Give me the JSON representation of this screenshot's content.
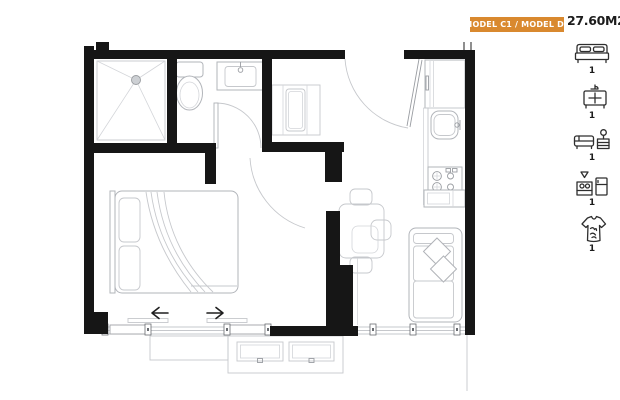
{
  "header": {
    "model_label": "MODEL C1 / MODEL D2",
    "area_label": "27.60M2"
  },
  "legend": {
    "items": [
      {
        "id": "bedroom",
        "icon": "bed-icon",
        "count": "1"
      },
      {
        "id": "bathroom",
        "icon": "bathroom-vanity-icon",
        "count": "1"
      },
      {
        "id": "living-room",
        "icon": "sofa-lamp-icon",
        "count": "1"
      },
      {
        "id": "kitchen",
        "icon": "kitchen-icon",
        "count": "1"
      },
      {
        "id": "wardrobe",
        "icon": "tshirt-icon",
        "count": "1"
      }
    ]
  },
  "colors": {
    "accent": "#D9892F",
    "wall": "#161616",
    "furniture_line": "#b2b5ba",
    "text": "#1c1c1c"
  }
}
